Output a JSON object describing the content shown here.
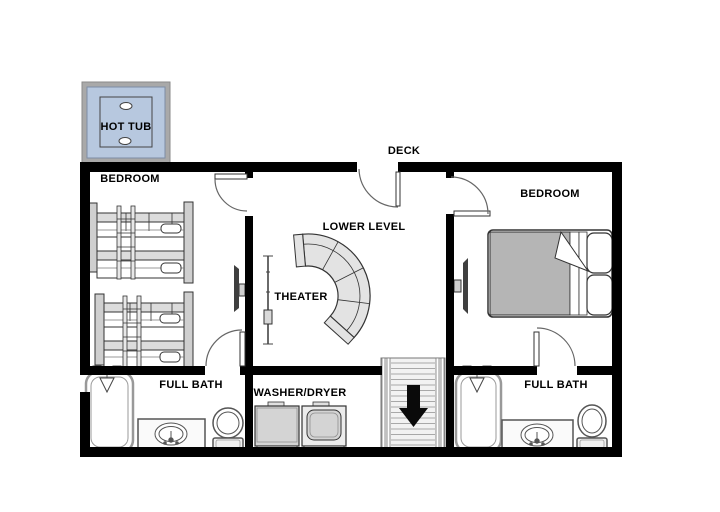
{
  "plan": {
    "labels": {
      "hot_tub": "HOT TUB",
      "deck": "DECK",
      "bedroom_left": "BEDROOM",
      "bedroom_right": "BEDROOM",
      "lower_level": "LOWER LEVEL",
      "theater": "THEATER",
      "full_bath_left": "FULL BATH",
      "washer_dryer": "WASHER/DRYER",
      "full_bath_right": "FULL BATH"
    },
    "stairs": {
      "direction_arrow": "down"
    },
    "colors": {
      "wall": "#000000",
      "hot_tub_fill": "#b7c8df",
      "hot_tub_border": "#a9a9a9",
      "furniture_gray": "#d4d4d4",
      "bed_blanket": "#b5b5b5",
      "sofa_fill": "#e3e3e3",
      "stairs_fill": "#f2f2f2",
      "tv_screen": "#3f3f3f"
    },
    "furniture": {
      "exterior": [
        "hot-tub"
      ],
      "bedroom_left": [
        "bunk-bed",
        "bunk-bed",
        "wall-tv"
      ],
      "theater": [
        "projection-screen",
        "curved-sectional-sofa"
      ],
      "bedroom_right": [
        "double-bed",
        "wall-tv"
      ],
      "full_bath_left": [
        "bathtub",
        "sink-vanity",
        "toilet"
      ],
      "laundry": [
        "washer",
        "dryer"
      ],
      "full_bath_right": [
        "bathtub",
        "sink-vanity",
        "toilet"
      ]
    }
  }
}
